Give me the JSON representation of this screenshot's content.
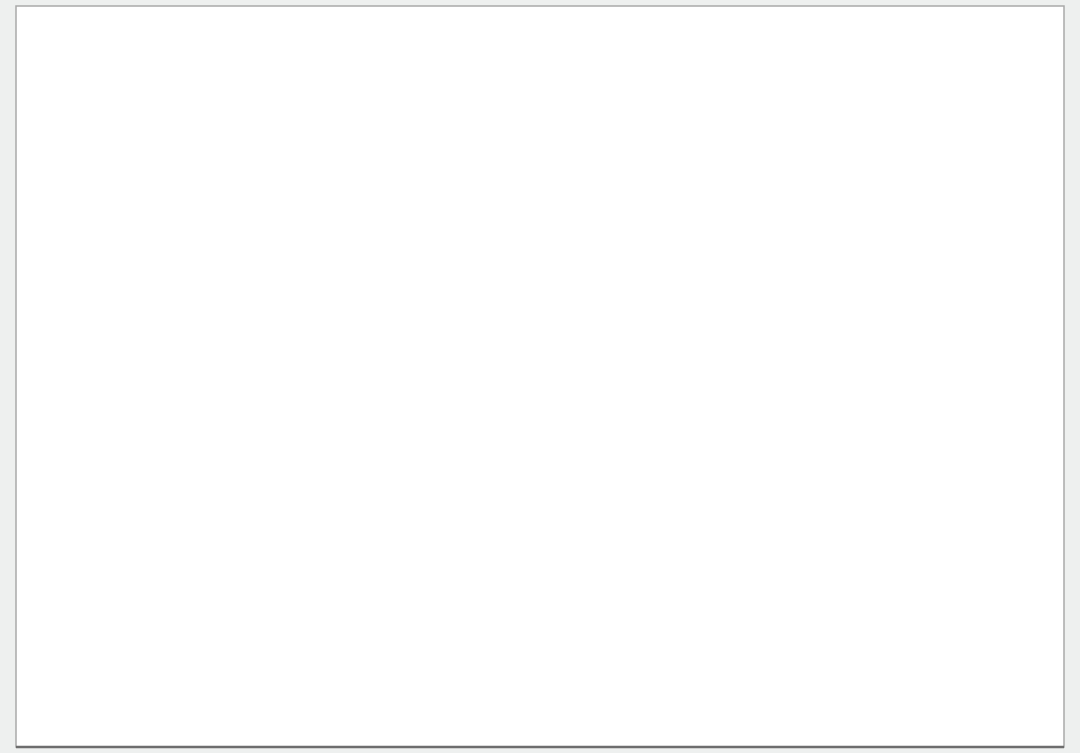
{
  "canvas": {
    "w": 1080,
    "h": 753,
    "bg": "#eef0ef",
    "sheet": {
      "x": 16,
      "y": 6,
      "w": 1048,
      "h": 741,
      "fill": "#ffffff",
      "stroke": "#a9a9a9"
    }
  },
  "colors": {
    "boundary": "#35c435",
    "block_stroke": "#cf3349",
    "lot_div": "#c2308a",
    "noise": "#ef7fc4",
    "road_casing": "#c2c2c2",
    "road_center": "#a8a8a8",
    "river": "#9fb6c6",
    "contour": "#a2621f",
    "purple_zone": "#9a05b5",
    "green_zone": "#17701f",
    "olive_zone": "#7d9342",
    "red_zone": "#cf1f10",
    "orange_parcel": "#e8a53c",
    "avenue_black": "#141414",
    "avenue_magenta": "#e320d6",
    "olive_outline": "#b5b56a",
    "purple_strip": "#7b5ec2",
    "tan": "#cdb67c",
    "tree_green": "#2ecc2e",
    "dark_tree": "#0d3f12",
    "gray_parcel": "#a8a8a8",
    "circle_marker": "#3d3d3d",
    "micro_red": "#b04030"
  },
  "labels": {
    "river": "O SAN PEDRO",
    "avenue": "AV. SIGLO XXI",
    "block_marker": "M14",
    "parcel_166": "166",
    "parcel_167": "167",
    "parcel_168": "168",
    "lot_row_numbers": [
      "176",
      "175",
      "174",
      "173",
      "172",
      "171"
    ]
  },
  "boundary_pts": [
    [
      15,
      147
    ],
    [
      233,
      10
    ],
    [
      258,
      9
    ],
    [
      300,
      13
    ],
    [
      340,
      21
    ],
    [
      392,
      40
    ],
    [
      452,
      64
    ],
    [
      470,
      72
    ],
    [
      1041,
      617
    ],
    [
      1056,
      638
    ],
    [
      1056,
      745
    ],
    [
      921,
      745
    ],
    [
      884,
      703
    ],
    [
      792,
      598
    ],
    [
      560,
      330
    ],
    [
      470,
      200
    ],
    [
      428,
      160
    ],
    [
      368,
      158
    ],
    [
      15,
      147
    ]
  ],
  "zones": {
    "green_tri": [
      [
        15,
        147
      ],
      [
        233,
        10
      ],
      [
        208,
        147
      ]
    ],
    "purple_tri": [
      [
        64,
        143
      ],
      [
        228,
        17
      ],
      [
        199,
        146
      ]
    ],
    "olive_wedge": [
      [
        110,
        105
      ],
      [
        172,
        60
      ],
      [
        182,
        90
      ],
      [
        122,
        115
      ]
    ],
    "red_tip": [
      [
        15,
        147
      ],
      [
        42,
        130
      ],
      [
        44,
        147
      ]
    ]
  },
  "river_lines": [
    [
      [
        0,
        50
      ],
      [
        60,
        38
      ],
      [
        120,
        22
      ],
      [
        180,
        10
      ],
      [
        228,
        4
      ]
    ],
    [
      [
        0,
        87
      ],
      [
        70,
        70
      ],
      [
        130,
        55
      ],
      [
        190,
        38
      ],
      [
        225,
        28
      ]
    ],
    [
      [
        0,
        125
      ],
      [
        60,
        110
      ],
      [
        110,
        96
      ],
      [
        160,
        80
      ],
      [
        200,
        68
      ]
    ],
    [
      [
        0,
        28
      ],
      [
        50,
        18
      ],
      [
        100,
        8
      ],
      [
        140,
        0
      ]
    ]
  ],
  "river_label_pos": {
    "x": 6,
    "y": 56,
    "angle": -27
  },
  "contour_chain": [
    [
      458,
      66
    ],
    [
      700,
      295
    ],
    [
      828,
      420
    ],
    [
      802,
      545
    ],
    [
      789,
      600
    ],
    [
      830,
      645
    ],
    [
      888,
      706
    ]
  ],
  "contour_spur": [
    [
      560,
      150
    ],
    [
      572,
      176
    ],
    [
      566,
      196
    ],
    [
      576,
      214
    ]
  ],
  "roads_internal": [
    {
      "pts": [
        [
          234,
          113
        ],
        [
          238,
          70
        ],
        [
          262,
          38
        ],
        [
          298,
          24
        ],
        [
          322,
          43
        ]
      ],
      "w": 9
    },
    {
      "pts": [
        [
          322,
          47
        ],
        [
          352,
          62
        ],
        [
          376,
          60
        ],
        [
          400,
          74
        ],
        [
          424,
          94
        ]
      ],
      "w": 9
    },
    {
      "pts": [
        [
          428,
          102
        ],
        [
          448,
          132
        ],
        [
          460,
          158
        ],
        [
          472,
          186
        ],
        [
          530,
          250
        ],
        [
          600,
          330
        ],
        [
          660,
          400
        ],
        [
          700,
          450
        ],
        [
          760,
          520
        ],
        [
          820,
          590
        ],
        [
          870,
          650
        ],
        [
          915,
          706
        ],
        [
          940,
          740
        ]
      ],
      "w": 9
    },
    {
      "pts": [
        [
          455,
          120
        ],
        [
          560,
          222
        ],
        [
          660,
          320
        ],
        [
          760,
          418
        ],
        [
          860,
          515
        ],
        [
          960,
          612
        ],
        [
          1006,
          652
        ]
      ],
      "w": 9
    },
    {
      "pts": [
        [
          428,
          160
        ],
        [
          520,
          268
        ],
        [
          620,
          390
        ],
        [
          720,
          512
        ],
        [
          810,
          622
        ],
        [
          900,
          733
        ]
      ],
      "w": 8
    }
  ],
  "access_road": [
    [
      [
        255,
        190
      ],
      [
        392,
        366
      ],
      [
        408,
        390
      ],
      [
        412,
        412
      ],
      [
        412,
        696
      ]
    ],
    [
      [
        268,
        182
      ],
      [
        404,
        356
      ],
      [
        424,
        384
      ],
      [
        428,
        410
      ],
      [
        428,
        696
      ]
    ],
    [
      [
        280,
        174
      ],
      [
        416,
        346
      ],
      [
        440,
        380
      ],
      [
        444,
        408
      ],
      [
        444,
        696
      ]
    ]
  ],
  "gray_parcel_pts": [
    [
      133,
      313
    ],
    [
      243,
      309
    ],
    [
      225,
      419
    ],
    [
      212,
      421
    ],
    [
      214,
      431
    ],
    [
      234,
      430
    ],
    [
      227,
      468
    ],
    [
      101,
      424
    ],
    [
      122,
      352
    ],
    [
      133,
      313
    ]
  ],
  "gray_lines": [
    [
      [
        0,
        297
      ],
      [
        133,
        313
      ]
    ],
    [
      [
        222,
        182
      ],
      [
        553,
        668
      ]
    ],
    [
      [
        553,
        668
      ],
      [
        792,
        597
      ]
    ]
  ],
  "avenue": {
    "black": [
      [
        [
          14,
          548
        ],
        [
          240,
          598
        ],
        [
          420,
          668
        ],
        [
          530,
          706
        ],
        [
          660,
          753
        ]
      ],
      [
        [
          14,
          610
        ],
        [
          200,
          652
        ],
        [
          367,
          706
        ],
        [
          460,
          740
        ],
        [
          515,
          753
        ]
      ]
    ],
    "gray": [
      [
        [
          14,
          560
        ],
        [
          250,
          608
        ],
        [
          430,
          676
        ],
        [
          540,
          714
        ],
        [
          640,
          753
        ]
      ],
      [
        [
          14,
          572
        ],
        [
          230,
          618
        ],
        [
          400,
          682
        ],
        [
          500,
          722
        ],
        [
          590,
          753
        ]
      ],
      [
        [
          14,
          590
        ],
        [
          220,
          632
        ],
        [
          380,
          694
        ],
        [
          470,
          732
        ],
        [
          540,
          753
        ]
      ],
      [
        [
          14,
          636
        ],
        [
          180,
          668
        ],
        [
          300,
          708
        ],
        [
          380,
          740
        ],
        [
          420,
          753
        ]
      ],
      [
        [
          14,
          650
        ],
        [
          160,
          680
        ],
        [
          260,
          714
        ],
        [
          330,
          745
        ]
      ]
    ],
    "magenta": [
      [
        14,
        592
      ],
      [
        250,
        640
      ],
      [
        430,
        700
      ],
      [
        520,
        728
      ],
      [
        600,
        753
      ]
    ],
    "island": {
      "x": 115,
      "y": 621,
      "w": 92,
      "h": 7,
      "angle": 11.5
    },
    "label_pos": {
      "x": 252,
      "y": 690,
      "angle": 11.5
    },
    "axis_text_dash": [
      [
        240,
        655
      ],
      [
        262,
        660
      ]
    ],
    "tan_box": {
      "x": 318,
      "y": 632,
      "w": 40,
      "h": 13,
      "angle": 11.5
    },
    "dims": [
      [
        [
          160,
          598
        ],
        [
          160,
          716
        ]
      ],
      [
        [
          203,
          606
        ],
        [
          203,
          724
        ]
      ],
      [
        [
          230,
          682
        ],
        [
          230,
          712
        ]
      ],
      [
        [
          247,
          690
        ],
        [
          247,
          718
        ]
      ]
    ]
  },
  "olive_shapes": [
    {
      "x1": 30,
      "x2": 92,
      "top": 672
    },
    {
      "x1": 108,
      "x2": 176,
      "top": 690
    },
    {
      "x1": 196,
      "x2": 258,
      "top": 706
    },
    {
      "x1": 300,
      "x2": 380,
      "top": 702
    },
    {
      "x1": 430,
      "x2": 560,
      "top": 726
    },
    {
      "x1": 686,
      "x2": 696,
      "top": 743
    }
  ],
  "blocks": [
    {
      "id": "row-a",
      "cx": 287,
      "cy": 72,
      "angle": -40,
      "l": 158,
      "w": 30,
      "lots": 11,
      "rows": 1,
      "circle": false
    },
    {
      "id": "row-b",
      "cx": 301,
      "cy": 137,
      "angle": 9,
      "l": 192,
      "w": 33,
      "lots": 13,
      "rows": 1,
      "circle": false
    },
    {
      "id": "m1",
      "cx": 489,
      "cy": 161,
      "angle": -47,
      "l": 112,
      "w": 54,
      "lots": 7
    },
    {
      "id": "m2",
      "cx": 541,
      "cy": 207,
      "angle": -47,
      "l": 128,
      "w": 56,
      "lots": 8
    },
    {
      "id": "m3",
      "cx": 592,
      "cy": 252,
      "angle": -47,
      "l": 128,
      "w": 56,
      "lots": 8
    },
    {
      "id": "m4",
      "cx": 630,
      "cy": 308,
      "angle": -47,
      "l": 148,
      "w": 58,
      "lots": 9
    },
    {
      "id": "m5",
      "cx": 554,
      "cy": 349,
      "angle": -47,
      "l": 88,
      "w": 46,
      "lots": 5
    },
    {
      "id": "m6",
      "cx": 687,
      "cy": 373,
      "angle": -47,
      "l": 148,
      "w": 58,
      "lots": 9
    },
    {
      "id": "m7",
      "cx": 747,
      "cy": 438,
      "angle": -47,
      "l": 158,
      "w": 60,
      "lots": 10
    },
    {
      "id": "m8",
      "cx": 787,
      "cy": 491,
      "angle": -47,
      "l": 150,
      "w": 58,
      "lots": 9
    },
    {
      "id": "m9",
      "cx": 849,
      "cy": 539,
      "angle": -47,
      "l": 150,
      "w": 58,
      "lots": 9
    },
    {
      "id": "m10",
      "cx": 904,
      "cy": 595,
      "angle": -47,
      "l": 142,
      "w": 58,
      "lots": 9
    },
    {
      "id": "m11",
      "cx": 925,
      "cy": 647,
      "angle": -47,
      "l": 108,
      "w": 48,
      "lots": 7
    },
    {
      "id": "m12",
      "cx": 989,
      "cy": 674,
      "angle": -47,
      "l": 118,
      "w": 52,
      "lots": 8
    },
    {
      "id": "ne-strip",
      "cx": 862,
      "cy": 452,
      "angle": 41.5,
      "l": 500,
      "w": 31,
      "lots": 32,
      "rows": 1,
      "circle": false
    },
    {
      "id": "p-strip-1",
      "cx": 1010,
      "cy": 694,
      "angle": 41.5,
      "l": 150,
      "w": 24,
      "lots": 14,
      "rows": 1,
      "circle": false,
      "stroke": "#7b5ec2",
      "div": "#7b5ec2"
    },
    {
      "id": "olive-band",
      "cx": 1008,
      "cy": 716,
      "angle": 41.5,
      "l": 170,
      "w": 13,
      "lots": 9,
      "rows": 1,
      "circle": false,
      "stroke": "#9a9a4a",
      "div": "#9a9a4a",
      "fill": "#e6dfae",
      "noise": false,
      "casing": false
    },
    {
      "id": "p-strip-2",
      "cx": 1036,
      "cy": 740,
      "angle": 41.5,
      "l": 120,
      "w": 18,
      "lots": 11,
      "rows": 1,
      "circle": false,
      "stroke": "#7b5ec2",
      "div": "#7b5ec2",
      "casing": false
    }
  ],
  "parcels": [
    {
      "cx": 369,
      "cy": 51,
      "angle": -40,
      "w": 44,
      "h": 38,
      "fill": "#e8a53c",
      "label": "parcel_167",
      "label_color": "#cc2200"
    },
    {
      "cx": 416,
      "cy": 60,
      "angle": -40,
      "w": 60,
      "h": 54,
      "fill": "#ffffff",
      "label": "parcel_166",
      "label_color": "#444444"
    },
    {
      "cx": 377,
      "cy": 96,
      "angle": -40,
      "w": 56,
      "h": 50,
      "fill": "#ffffff",
      "label": "parcel_168",
      "label_color": "#444444"
    },
    {
      "cx": 424,
      "cy": 112,
      "angle": -40,
      "w": 50,
      "h": 46,
      "fill": "#ffffff"
    }
  ],
  "triangle_parcel": [
    [
      448,
      78
    ],
    [
      482,
      94
    ],
    [
      452,
      122
    ]
  ],
  "circles": [
    {
      "x": 687,
      "y": 267,
      "r": 7.5
    },
    {
      "x": 306,
      "y": 152,
      "r": 7
    },
    {
      "x": 462,
      "y": 97,
      "r": 6
    },
    {
      "x": 150,
      "y": 100,
      "r": 7
    }
  ],
  "m_circle": {
    "x": 358,
    "y": 73,
    "r": 9.5
  },
  "road_circles": [
    {
      "x": 428,
      "y": 99,
      "r": 13,
      "inner": 4.5
    },
    {
      "x": 319,
      "y": 46,
      "r": 12,
      "inner": 0
    },
    {
      "x": 117,
      "y": 63,
      "r": 8,
      "inner": 0
    }
  ],
  "trees_top": [
    [
      333,
      17
    ],
    [
      343,
      20
    ],
    [
      352,
      23
    ],
    [
      372,
      29
    ],
    [
      382,
      33
    ],
    [
      392,
      36
    ]
  ],
  "green_band_top": [
    [
      333,
      15
    ],
    [
      452,
      60
    ]
  ],
  "micro_text_top": [
    [
      342,
      19
    ],
    [
      428,
      46
    ]
  ],
  "entrance_icons": {
    "green_box_top": {
      "x": 447,
      "y": 61,
      "w": 17,
      "h": 10,
      "angle": -25
    },
    "gray_dot": {
      "x": 443,
      "y": 37,
      "r": 3
    },
    "magenta_marks": [
      {
        "x": 433,
        "y": 118,
        "w": 7,
        "h": 9
      },
      {
        "x": 440,
        "y": 126,
        "w": 6,
        "h": 8
      }
    ],
    "play_green": {
      "x": 641,
      "y": 399,
      "w": 17,
      "h": 12,
      "angle": -4
    },
    "kiosk_tan": {
      "x": 645,
      "y": 425,
      "w": 28,
      "h": 20,
      "angle": 42
    },
    "red_dot": {
      "x": 633,
      "y": 406,
      "r": 2
    }
  },
  "bottom_cluster": {
    "green_sq": [
      [
        872,
        693
      ],
      [
        884,
        706
      ],
      [
        896,
        719
      ],
      [
        908,
        732
      ],
      [
        920,
        744
      ],
      [
        902,
        688
      ],
      [
        914,
        700
      ],
      [
        926,
        712
      ],
      [
        938,
        724
      ],
      [
        950,
        737
      ]
    ],
    "tan_sq": [
      [
        934,
        686
      ],
      [
        958,
        706
      ]
    ],
    "orange_sq": [
      [
        947,
        698
      ]
    ],
    "dots": [
      [
        880,
        690
      ],
      [
        893,
        702
      ],
      [
        906,
        715
      ],
      [
        918,
        727
      ],
      [
        931,
        740
      ],
      [
        944,
        716
      ],
      [
        955,
        728
      ]
    ]
  },
  "black_diag": [
    [
      899,
      753
    ],
    [
      1013,
      685
    ]
  ],
  "lot_row_pos": {
    "x0": 213,
    "y0": 128,
    "dx": 21.5,
    "dy": 1.1,
    "angle": 9
  }
}
